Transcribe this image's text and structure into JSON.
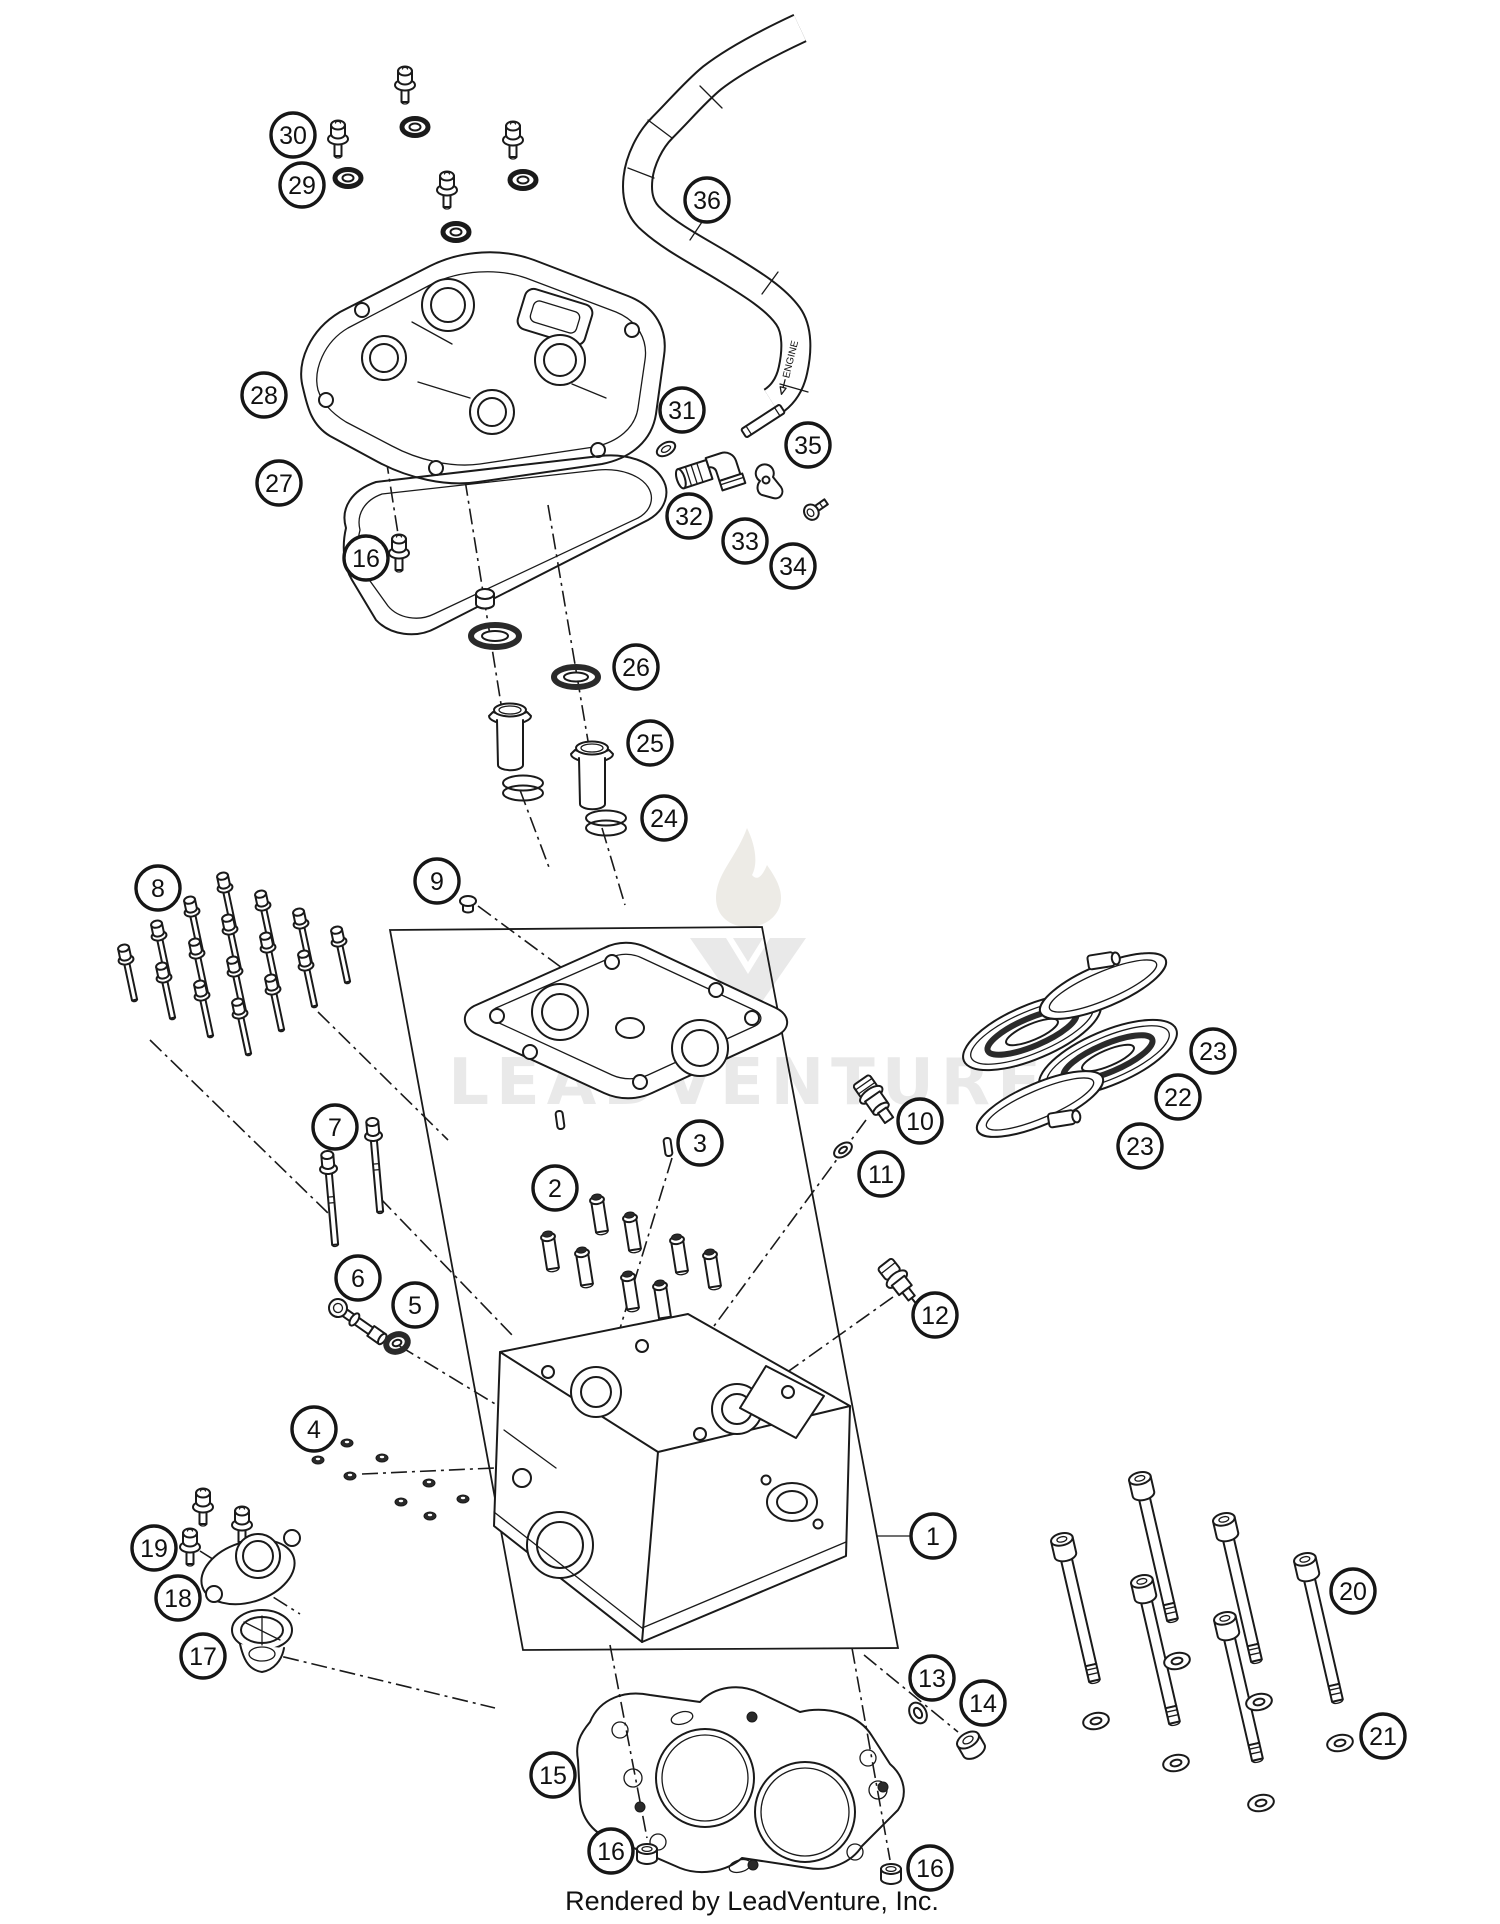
{
  "footer": {
    "text": "Rendered by LeadVenture, Inc."
  },
  "watermark": {
    "text": "LEADVENTURE",
    "color": "#e9e9e9",
    "flame_color": "#edebe6"
  },
  "hose_label": "ENGINE",
  "colors": {
    "line": "#1a1a1a",
    "background": "#ffffff",
    "watermark": "#e9e9e9"
  },
  "callouts": [
    {
      "label": "30",
      "x": 293,
      "y": 135
    },
    {
      "label": "29",
      "x": 302,
      "y": 185
    },
    {
      "label": "36",
      "x": 707,
      "y": 200
    },
    {
      "label": "28",
      "x": 264,
      "y": 395
    },
    {
      "label": "27",
      "x": 279,
      "y": 483
    },
    {
      "label": "31",
      "x": 682,
      "y": 410
    },
    {
      "label": "35",
      "x": 808,
      "y": 445
    },
    {
      "label": "32",
      "x": 689,
      "y": 516
    },
    {
      "label": "33",
      "x": 745,
      "y": 541
    },
    {
      "label": "34",
      "x": 793,
      "y": 566
    },
    {
      "label": "16",
      "x": 366,
      "y": 558
    },
    {
      "label": "26",
      "x": 636,
      "y": 667
    },
    {
      "label": "25",
      "x": 650,
      "y": 743
    },
    {
      "label": "24",
      "x": 664,
      "y": 818
    },
    {
      "label": "8",
      "x": 158,
      "y": 888
    },
    {
      "label": "9",
      "x": 437,
      "y": 881
    },
    {
      "label": "7",
      "x": 335,
      "y": 1127
    },
    {
      "label": "2",
      "x": 555,
      "y": 1188
    },
    {
      "label": "3",
      "x": 700,
      "y": 1143
    },
    {
      "label": "10",
      "x": 920,
      "y": 1121
    },
    {
      "label": "11",
      "x": 881,
      "y": 1174
    },
    {
      "label": "12",
      "x": 935,
      "y": 1315
    },
    {
      "label": "6",
      "x": 358,
      "y": 1278
    },
    {
      "label": "5",
      "x": 415,
      "y": 1305
    },
    {
      "label": "4",
      "x": 314,
      "y": 1429
    },
    {
      "label": "23",
      "x": 1213,
      "y": 1051
    },
    {
      "label": "22",
      "x": 1178,
      "y": 1097
    },
    {
      "label": "23",
      "x": 1140,
      "y": 1146
    },
    {
      "label": "19",
      "x": 154,
      "y": 1548
    },
    {
      "label": "18",
      "x": 178,
      "y": 1598
    },
    {
      "label": "17",
      "x": 203,
      "y": 1656
    },
    {
      "label": "1",
      "x": 933,
      "y": 1536
    },
    {
      "label": "20",
      "x": 1353,
      "y": 1591
    },
    {
      "label": "21",
      "x": 1383,
      "y": 1736
    },
    {
      "label": "13",
      "x": 932,
      "y": 1678
    },
    {
      "label": "14",
      "x": 983,
      "y": 1703
    },
    {
      "label": "15",
      "x": 553,
      "y": 1775
    },
    {
      "label": "16",
      "x": 611,
      "y": 1851
    },
    {
      "label": "16",
      "x": 930,
      "y": 1868
    }
  ],
  "parts": {
    "cover_bolts": [
      [
        405,
        78
      ],
      [
        338,
        132
      ],
      [
        513,
        133
      ],
      [
        447,
        183
      ]
    ],
    "cover_seals": [
      [
        415,
        127
      ],
      [
        348,
        178
      ],
      [
        523,
        180
      ],
      [
        456,
        232
      ]
    ],
    "carrier_bolts": [
      [
        125,
        955
      ],
      [
        158,
        931
      ],
      [
        191,
        907
      ],
      [
        224,
        883
      ],
      [
        163,
        973
      ],
      [
        196,
        949
      ],
      [
        229,
        925
      ],
      [
        262,
        901
      ],
      [
        201,
        991
      ],
      [
        234,
        967
      ],
      [
        267,
        943
      ],
      [
        300,
        919
      ],
      [
        239,
        1009
      ],
      [
        272,
        985
      ],
      [
        305,
        961
      ],
      [
        338,
        937
      ]
    ],
    "head_studs": [
      [
        328,
        1163
      ],
      [
        373,
        1130
      ]
    ],
    "valve_guides": [
      [
        548,
        1237
      ],
      [
        582,
        1253
      ],
      [
        597,
        1200
      ],
      [
        630,
        1218
      ],
      [
        628,
        1277
      ],
      [
        660,
        1286
      ],
      [
        677,
        1240
      ],
      [
        710,
        1255
      ]
    ],
    "head_nuts": [
      [
        347,
        1443
      ],
      [
        318,
        1460
      ],
      [
        382,
        1458
      ],
      [
        350,
        1476
      ],
      [
        429,
        1483
      ],
      [
        401,
        1502
      ],
      [
        463,
        1499
      ],
      [
        430,
        1516
      ]
    ],
    "therm_bolts": [
      [
        203,
        1500
      ],
      [
        242,
        1518
      ],
      [
        190,
        1540
      ]
    ],
    "long_bolts": [
      [
        1065,
        1553
      ],
      [
        1143,
        1492
      ],
      [
        1145,
        1595
      ],
      [
        1227,
        1533
      ],
      [
        1228,
        1632
      ],
      [
        1308,
        1573
      ]
    ],
    "bolt_washers": [
      [
        1096,
        1721
      ],
      [
        1177,
        1661
      ],
      [
        1176,
        1763
      ],
      [
        1259,
        1702
      ],
      [
        1261,
        1803
      ],
      [
        1340,
        1743
      ]
    ]
  }
}
